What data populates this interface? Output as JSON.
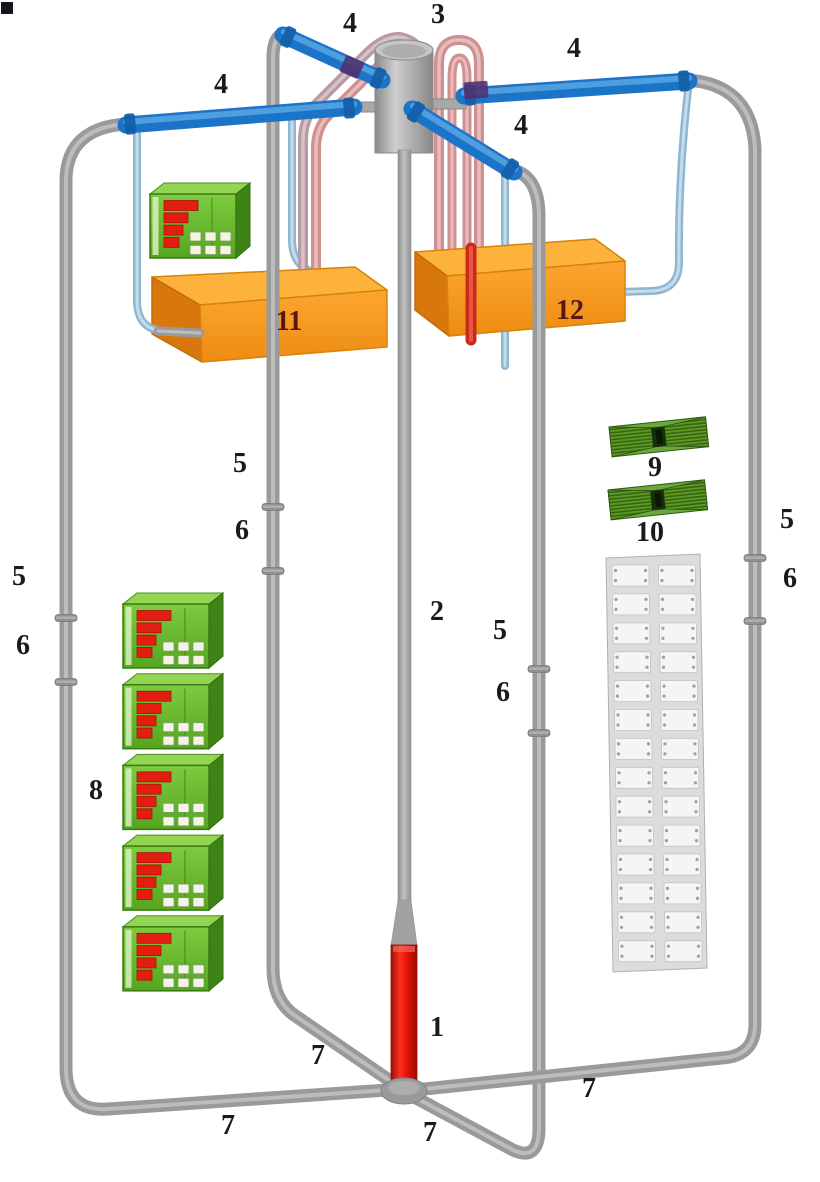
{
  "figure": {
    "type": "3d-apparatus-schematic",
    "background": "#ffffff",
    "width": 820,
    "height": 1182
  },
  "palette": {
    "pipe_gray": "#9a9a9a",
    "loop_pipe_blue": "#1b74c8",
    "coolant_line_lightblue": "#9fc2da",
    "heater_tube_pink": "#cf9090",
    "bath_box_orange": "#f79b22",
    "controller_green": "#64b82c",
    "display_bar_red": "#e31e10",
    "evaporator_section_red": "#e02010",
    "terminal_panel_gray": "#dcdcdc",
    "fin_device_green": "#55901e",
    "label_color": "#1a1a1a",
    "box_label_color": "#5a1515"
  },
  "labels": [
    {
      "text": "4",
      "x": 350,
      "y": 24
    },
    {
      "text": "3",
      "x": 438,
      "y": 15
    },
    {
      "text": "4",
      "x": 574,
      "y": 49
    },
    {
      "text": "4",
      "x": 221,
      "y": 85
    },
    {
      "text": "4",
      "x": 521,
      "y": 126
    },
    {
      "text": "5",
      "x": 19,
      "y": 577
    },
    {
      "text": "6",
      "x": 23,
      "y": 646
    },
    {
      "text": "5",
      "x": 240,
      "y": 464
    },
    {
      "text": "6",
      "x": 242,
      "y": 531
    },
    {
      "text": "2",
      "x": 437,
      "y": 612
    },
    {
      "text": "5",
      "x": 500,
      "y": 631
    },
    {
      "text": "6",
      "x": 503,
      "y": 693
    },
    {
      "text": "5",
      "x": 787,
      "y": 520
    },
    {
      "text": "6",
      "x": 790,
      "y": 579
    },
    {
      "text": "9",
      "x": 655,
      "y": 468
    },
    {
      "text": "10",
      "x": 650,
      "y": 533
    },
    {
      "text": "8",
      "x": 96,
      "y": 791
    },
    {
      "text": "11",
      "x": 289,
      "y": 322,
      "color": "#5a1515"
    },
    {
      "text": "12",
      "x": 570,
      "y": 311,
      "color": "#5a1515"
    },
    {
      "text": "1",
      "x": 437,
      "y": 1028
    },
    {
      "text": "7",
      "x": 318,
      "y": 1056
    },
    {
      "text": "7",
      "x": 228,
      "y": 1126
    },
    {
      "text": "7",
      "x": 430,
      "y": 1133
    },
    {
      "text": "7",
      "x": 589,
      "y": 1089
    }
  ],
  "controller_stack": {
    "count": 5,
    "x": 123,
    "y0": 604,
    "spacing": 80.7
  },
  "terminal_panel": {
    "rows": 14,
    "cols": 2
  },
  "fin_devices": {
    "count": 2
  },
  "corner_mark": {
    "present": true
  }
}
